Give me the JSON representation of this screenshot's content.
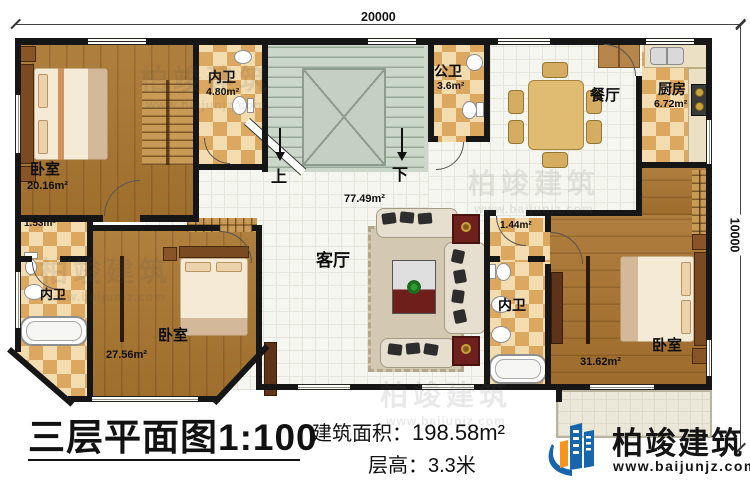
{
  "dimensions": {
    "top": "20000",
    "right": "10000"
  },
  "stairs": {
    "up": "上",
    "down": "下"
  },
  "rooms": {
    "bedroom_tl": {
      "name": "卧室",
      "area": "20.16m²"
    },
    "bath_tl": {
      "name": "内卫",
      "area": "4.80m²"
    },
    "public_bath": {
      "name": "公卫",
      "area": "3.6m²"
    },
    "dining": {
      "name": "餐厅"
    },
    "kitchen": {
      "name": "厨房",
      "area": "6.72m²"
    },
    "living": {
      "name": "客厅",
      "area": "77.49m²"
    },
    "closet_bl": {
      "area": "1.53m²"
    },
    "bath_bl": {
      "name": "内卫"
    },
    "bedroom_bl": {
      "name": "卧室",
      "area": "27.56m²"
    },
    "closet_br": {
      "area": "1.44m²"
    },
    "bath_br": {
      "name": "内卫"
    },
    "bedroom_br": {
      "name": "卧室",
      "area": "31.62m²"
    }
  },
  "legend": {
    "title": "三层平面图",
    "scale": "1:100",
    "area_label": "建筑面积：",
    "area_value": "198.58m²",
    "floor_height_label": "层高：",
    "floor_height_value": "3.3米"
  },
  "branding": {
    "company": "柏竣建筑",
    "website": "www.baijunjz.com"
  }
}
